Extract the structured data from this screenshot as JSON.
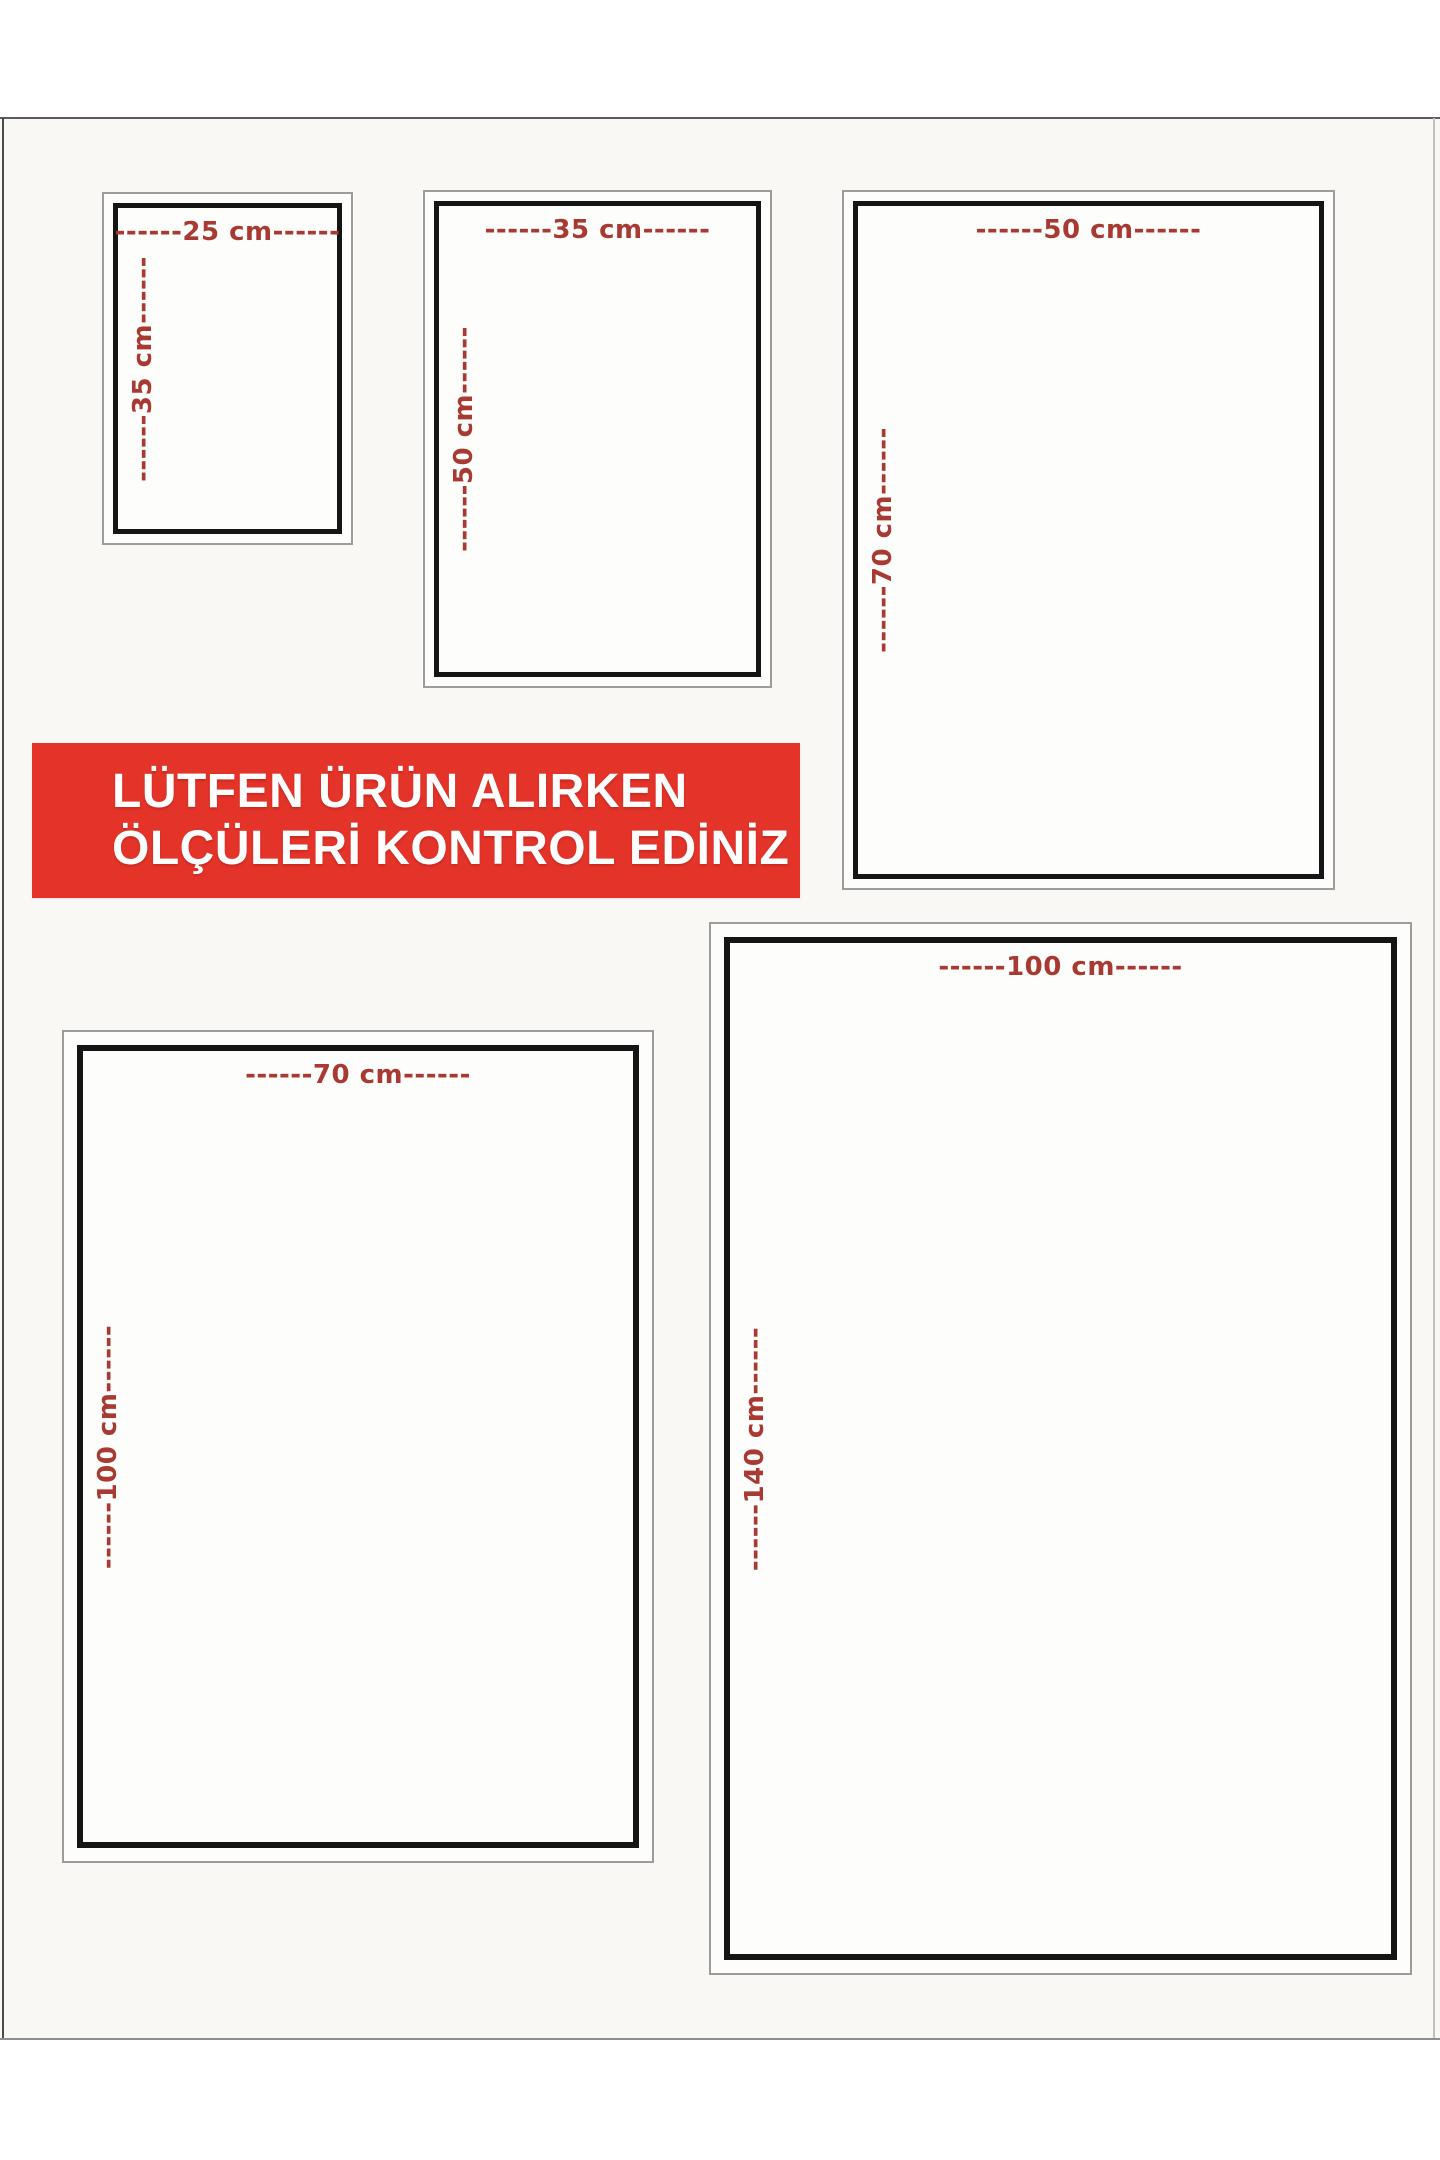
{
  "page": {
    "background": "#ffffff",
    "sheet_background": "#faf8f5"
  },
  "banner": {
    "line1": "LÜTFEN ÜRÜN ALIRKEN",
    "line2": "ÖLÇÜLERİ KONTROL EDİNİZ",
    "background": "#e4342a",
    "text_color": "#ffffff"
  },
  "label_color": "#a93a33",
  "size_boxes": [
    {
      "id": "25x35",
      "top_label": "------25 cm------",
      "side_label": "------35 cm------"
    },
    {
      "id": "35x50",
      "top_label": "------35 cm------",
      "side_label": "------50 cm------"
    },
    {
      "id": "50x70",
      "top_label": "------50 cm------",
      "side_label": "------70 cm------"
    },
    {
      "id": "70x100",
      "top_label": "------70 cm------",
      "side_label": "------100 cm------"
    },
    {
      "id": "100x140",
      "top_label": "------100 cm------",
      "side_label": "------140 cm------"
    }
  ]
}
